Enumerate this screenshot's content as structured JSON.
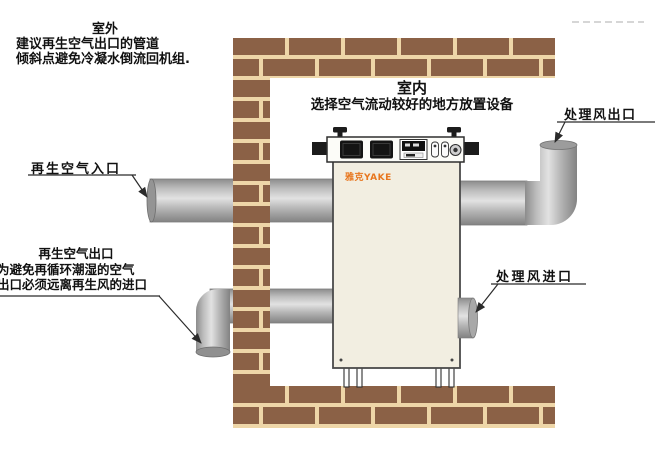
{
  "canvas": {
    "width": 655,
    "height": 457
  },
  "colors": {
    "background": "#ffffff",
    "brick": "#8b6146",
    "mortar": "#eed6a8",
    "machine_body": "#f2eee1",
    "machine_outline": "#4a4a4a",
    "logo_orange": "#e8761e",
    "pipe_light": "#e2e2e2",
    "pipe_dark": "#828282",
    "annotation_line": "#2b2b2b",
    "text": "#111111"
  },
  "labels": {
    "outdoor_note": {
      "title": "室外",
      "line2": "建议再生空气出口的管道",
      "line3": "倾斜点避免冷凝水倒流回机组."
    },
    "indoor_note": {
      "title": "室内",
      "line2": "选择空气流动较好的地方放置设备"
    },
    "regen_air_inlet": "再生空气入口",
    "regen_air_outlet_note": {
      "line1": "再生空气出口",
      "line2": "为避免再循环潮湿的空气",
      "line3": "出口必须远离再生风的进口"
    },
    "process_air_inlet": "处理风进口",
    "process_air_outlet": "处理风出口"
  },
  "machine": {
    "brand": "雅克YAKE"
  }
}
